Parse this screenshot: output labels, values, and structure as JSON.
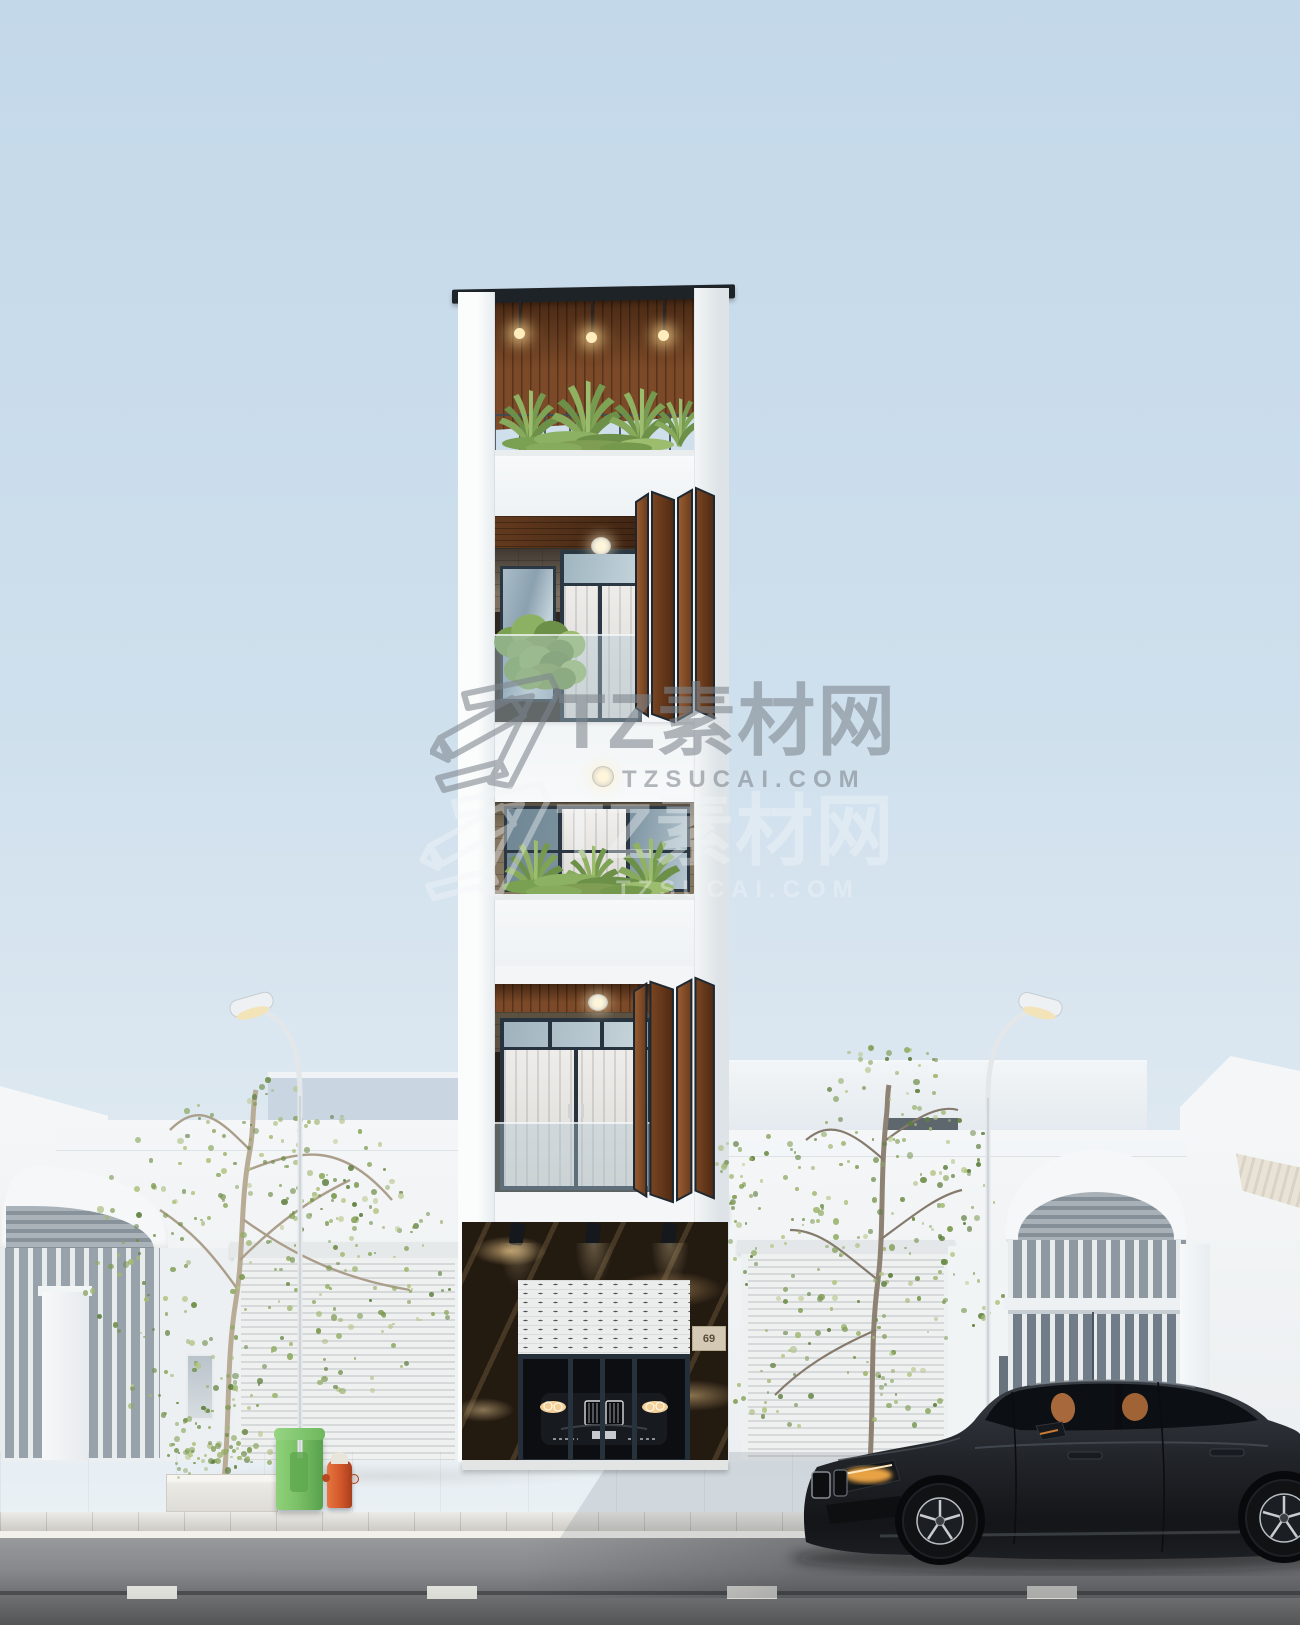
{
  "meta": {
    "kind": "3D architectural exterior rendering",
    "description": "Street elevation of a narrow 5-storey modern tube house between single-storey neighbours, with a dark sedan parked on the road",
    "width_px": 1300,
    "height_px": 1625
  },
  "watermark": {
    "brand": "TZ素材网",
    "site": "TZSUCAI.COM",
    "color_primary": "#7d858d",
    "color_secondary": "#f3f6f8"
  },
  "building": {
    "house_number": "69",
    "floors": 5,
    "palette": {
      "wall": "#f3f5f6",
      "roof_cap": "#1e2327",
      "wood_louver": "#7c4a28",
      "window_frame": "#2b3742",
      "marble_base": "#231a10",
      "curtain": "#eae8e4"
    },
    "features": [
      "roof terrace with pendant lights and plants",
      "folding wooden louver shutters",
      "brick accent walls",
      "glass balustrades",
      "marble-clad garage with roller shutter",
      "car inside garage with headlights on"
    ]
  },
  "neighbours": {
    "left": [
      "arched corrugated gate canopy",
      "vertical bar fence",
      "roller shutter door"
    ],
    "right": [
      "roller shutter door",
      "arched gate with bar screen",
      "awning building far right"
    ]
  },
  "street": {
    "road_color": "#8e9092",
    "lane_marking_color": "#edede8",
    "sidewalk_color": "#d3d1ca",
    "curb_edge_color": "#f1f0ea",
    "objects": [
      "street lamp left",
      "street lamp right",
      "green trash bin",
      "fire hydrant",
      "planter box with shrub",
      "young street trees"
    ]
  },
  "car": {
    "type": "sedan, parked facing left",
    "body_color": "#23262b",
    "headlight_color": "#ffb24a",
    "interior_color": "#b06f3d",
    "rim_color": "#c7cbd0"
  },
  "sky": {
    "top": "#c3d8e9",
    "bottom": "#edf2f5"
  },
  "vegetation": {
    "foliage_colors": [
      "#8faa62",
      "#7d9a50",
      "#a3b874",
      "#6d8c46",
      "#b3c584"
    ]
  }
}
